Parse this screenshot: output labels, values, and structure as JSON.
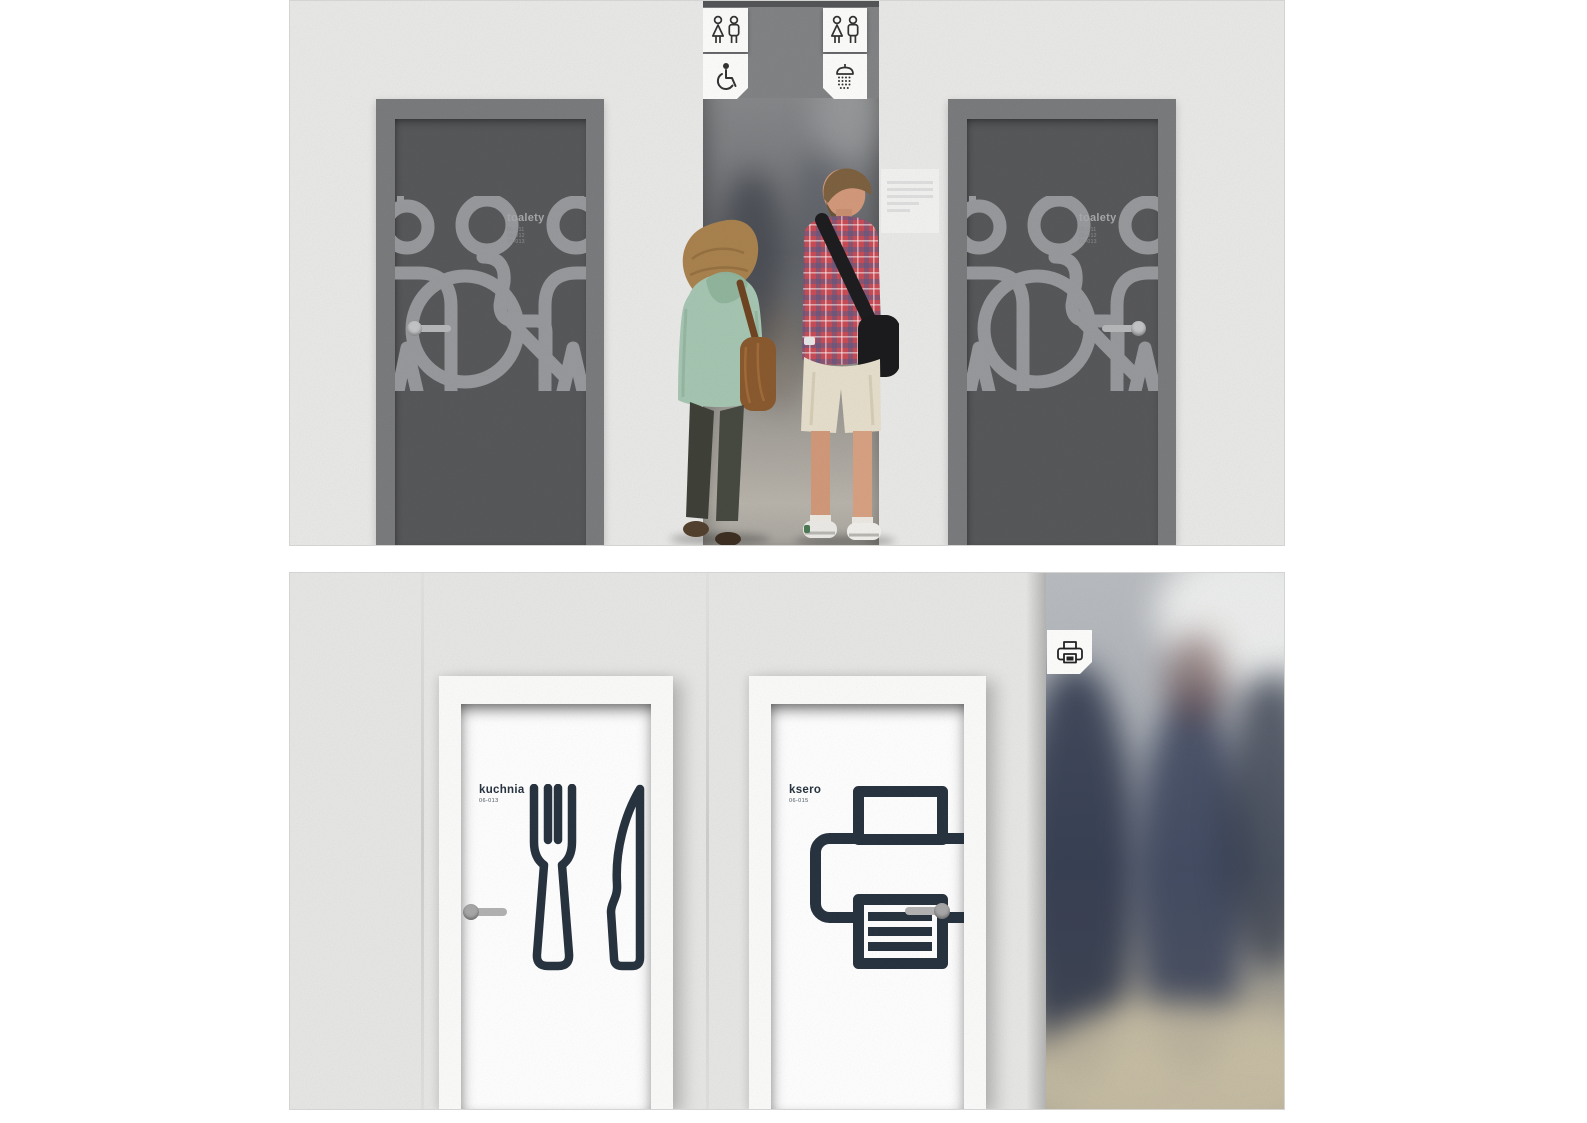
{
  "board": {
    "background": "#ffffff"
  },
  "top_panel": {
    "wall_color": "#e9e9e8",
    "door_frame_color": "#797b7d",
    "door_leaf_color": "#57585a",
    "pictogram_color": "#97999c",
    "corridor_beam_color": "#818385",
    "tabs": {
      "left": {
        "icons": [
          "wc-women-men-icon",
          "wheelchair-icon"
        ]
      },
      "right": {
        "icons": [
          "wc-women-men-icon",
          "shower-icon"
        ]
      }
    },
    "doors": [
      {
        "label": "toalety",
        "sublines": [
          "06-011",
          "06-012",
          "06-013"
        ],
        "handle_side": "left"
      },
      {
        "label": "toalety",
        "sublines": [
          "06-011",
          "06-012",
          "06-013"
        ],
        "handle_side": "right"
      }
    ],
    "people": [
      {
        "name": "woman-mint-jacket",
        "jacket_color": "#a6c6b2",
        "hair_color": "#a9824e",
        "jeans_color": "#3f4139",
        "bag_color": "#8a5a2e"
      },
      {
        "name": "man-plaid-shirt",
        "shirt_color": "#c84c57",
        "shorts_color": "#e7dfcc",
        "bag_color": "#1b1b1d",
        "shoe_color": "#eceae6"
      }
    ]
  },
  "bottom_panel": {
    "wall_color": "#e7e7e6",
    "door_color": "#ffffff",
    "icon_color": "#27333f",
    "doors": [
      {
        "label": "kuchnia",
        "code": "06-013",
        "icon": "fork-knife-icon",
        "handle_side": "left"
      },
      {
        "label": "ksero",
        "code": "06-015",
        "icon": "printer-icon",
        "handle_side": "right"
      }
    ],
    "corner_tab": {
      "icon": "printer-icon"
    },
    "photo_strip_colors": {
      "figures": "#232c42",
      "floor": "#c7bda4",
      "light": "#f2f3f2"
    }
  }
}
